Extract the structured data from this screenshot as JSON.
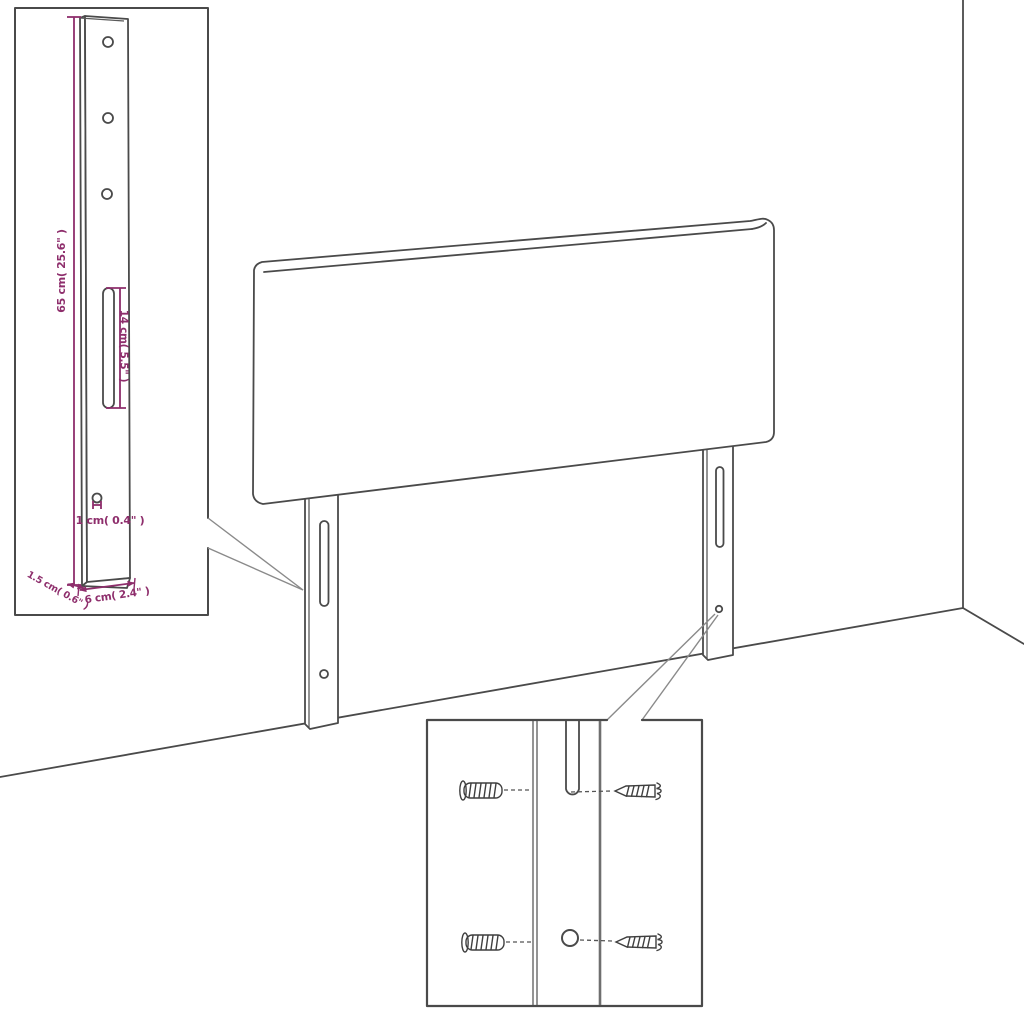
{
  "diagram": {
    "labels": {
      "bracket_height": "65 cm( 25.6\" )",
      "slot_length": "14 cm( 5.5\" )",
      "hole_diameter": "1 cm( 0.4\" )",
      "bracket_depth": "1.5 cm( 0.6\" )",
      "bracket_width": "6 cm( 2.4\" )"
    },
    "colors": {
      "dimension": "#8e2e6c",
      "line_art": "#4a4a4a"
    }
  }
}
